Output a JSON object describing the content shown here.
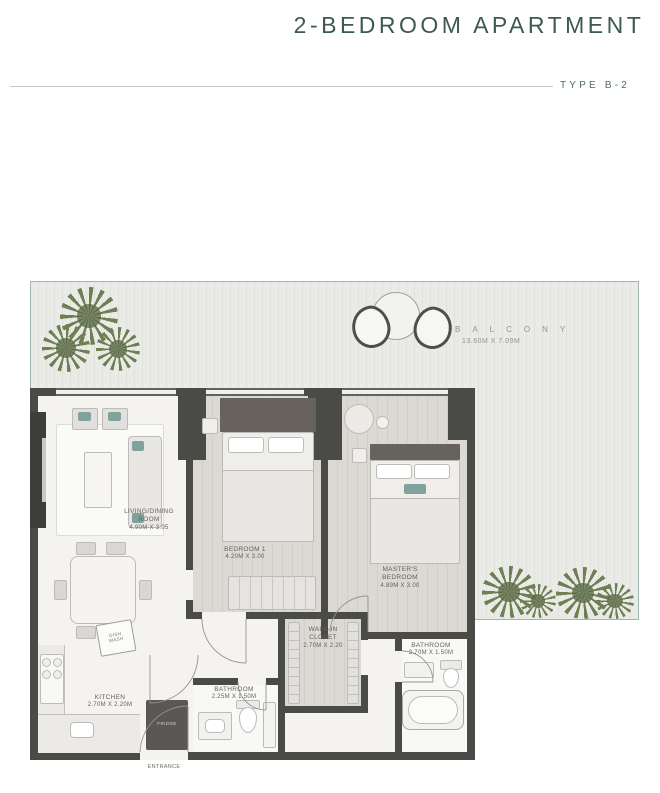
{
  "header": {
    "title": "2-BEDROOM APARTMENT",
    "type_label": "TYPE B-2"
  },
  "balcony": {
    "name": "BALCONY",
    "dims": "13.60M X 7.09M"
  },
  "rooms": {
    "living": {
      "name": "LIVING/DINING\nROOM",
      "dims": "4.90M X 3.05"
    },
    "bedroom1": {
      "name": "BEDROOM 1",
      "dims": "4.20M X 3.00"
    },
    "master": {
      "name": "MASTER'S\nBEDROOM",
      "dims": "4.89M X 3.00"
    },
    "walkin": {
      "name": "WALK-IN\nCLOSET",
      "dims": "2.70M X 2.20"
    },
    "bathroom_master": {
      "name": "BATHROOM",
      "dims": "2.70M X 1.50M"
    },
    "bathroom2": {
      "name": "BATHROOM",
      "dims": "2.25M X 1.50M"
    },
    "kitchen": {
      "name": "KITCHEN",
      "dims": "2.70M X 2.20M"
    }
  },
  "appliances": {
    "fridge": "FRIDGE",
    "dishwasher": "DISH\nWASH"
  },
  "entrance_label": "ENTRANCE",
  "colors": {
    "accent_teal": "#3c5954",
    "wall": "#4a4a47",
    "balcony_border": "#9db6b0",
    "plant_green": "#6d7f53"
  }
}
